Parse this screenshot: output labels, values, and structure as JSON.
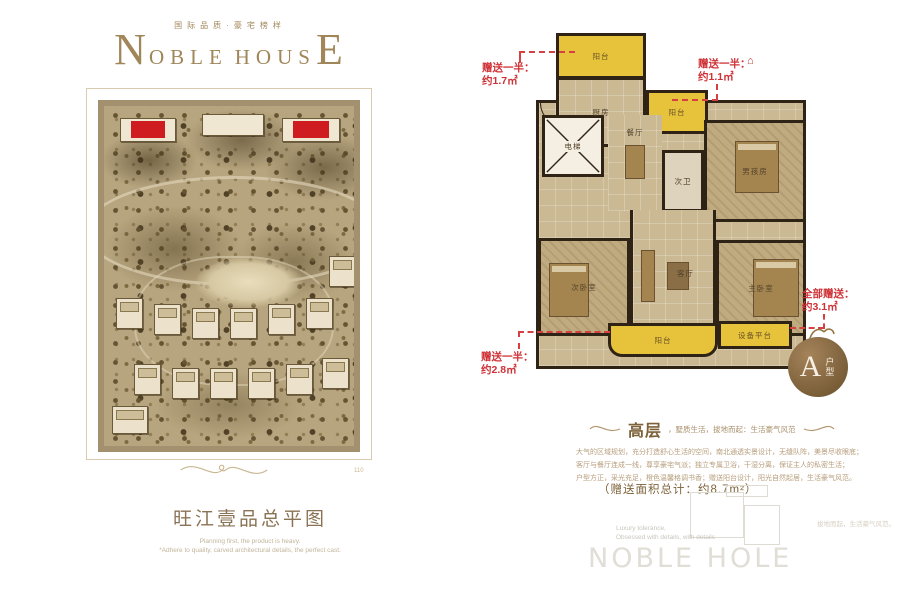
{
  "brand": {
    "tagline": "国际品质·豪宅榜样",
    "logo_parts": {
      "n": "N",
      "oble": "OBLE",
      "hous": "HOUS",
      "e": "E"
    },
    "watermark": "NOBLE HOLE"
  },
  "site_plan": {
    "title": "旺江壹品总平图",
    "caption_line1": "Planning first, the product is heavy.",
    "caption_line2": "*Adhere to quality, carved architectural details, the perfect cast.",
    "plate_no": "110"
  },
  "floor_plan": {
    "rooms": {
      "balcony_top": "阳台",
      "kitchen": "厨房",
      "balcony_mid": "阳台",
      "elevator": "电梯",
      "dining": "餐厅",
      "bath2": "次卫",
      "boy_room": "男孩房",
      "bedroom2": "次卧室",
      "living": "客厅",
      "master_bedroom": "主卧室",
      "balcony_bottom": "阳台",
      "equipment": "设备平台"
    },
    "annotations": {
      "top_left": {
        "label": "赠送一半：",
        "value": "约1.7㎡"
      },
      "top_right": {
        "label": "赠送一半：",
        "value": "约1.1㎡"
      },
      "right": {
        "label": "全部赠送：",
        "value": "约3.1㎡"
      },
      "bottom_left": {
        "label": "赠送一半：",
        "value": "约2.8㎡"
      }
    },
    "unit_badge": {
      "letter": "A",
      "suffix": "户型"
    },
    "icons": {
      "house": "⌂"
    },
    "accent_red": "#cf3236",
    "balcony_yellow": "#e7c33c"
  },
  "description": {
    "heading_strong": "高层",
    "heading_small": "，墅质生活，拔地而起：生活豪气风范",
    "body_lines": [
      "大气的区域规划，充分打造舒心生活的空间，南北通透实景设计，无缝队阵，美景尽收眼底；",
      "客厅与餐厅连成一线，尊享豪宅气派；独立专属卫浴，干湿分离，保证主人的私密生活；",
      "户型方正，采光充足，橙色温馨格调书香；赠送阳台设计，阳光自然起居，生活豪气风范。"
    ],
    "total_area": "（赠送面积总计：约8.7m²）",
    "english_line1": "Luxury tolerance,",
    "english_line2": "Obsessed with details, with details",
    "faint_right": "拔地而起，生活豪气风范。"
  }
}
